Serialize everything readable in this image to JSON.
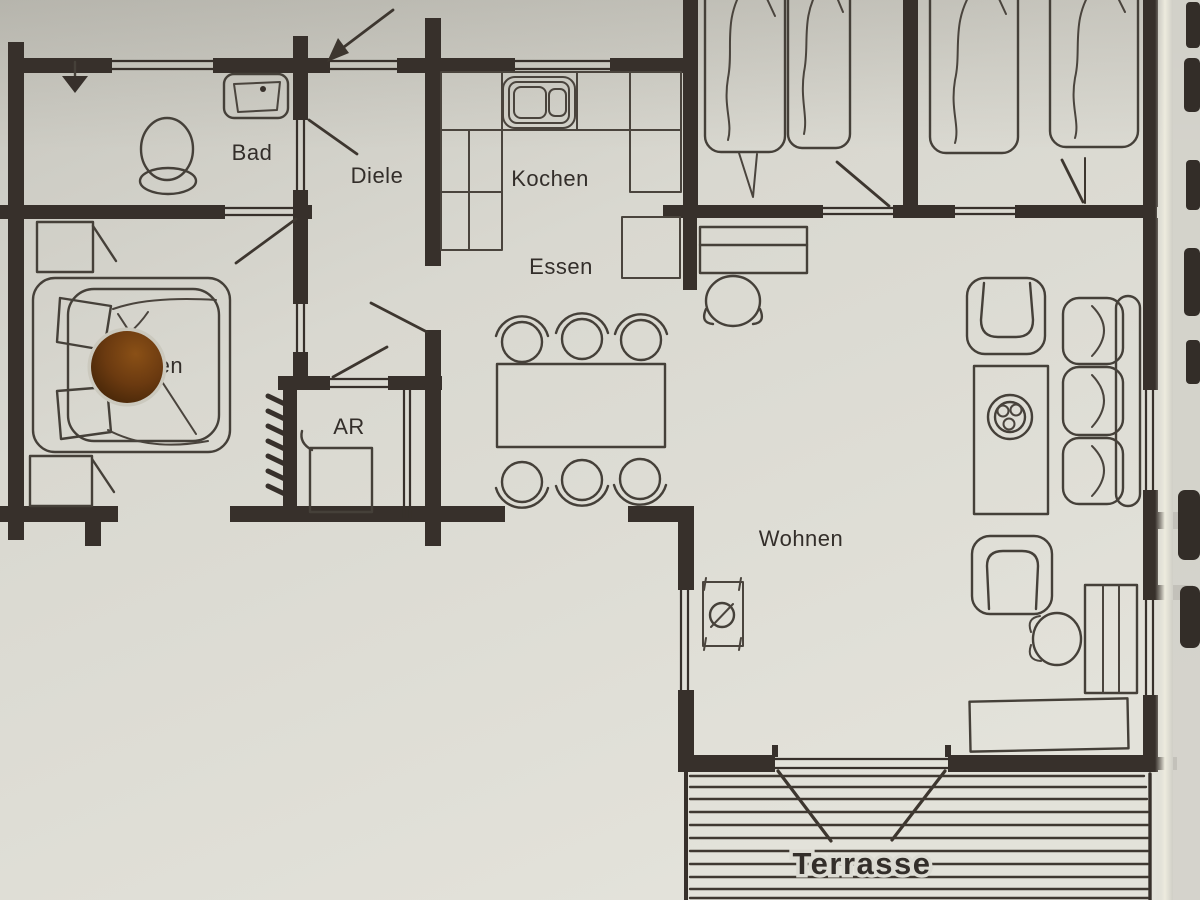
{
  "document": {
    "type": "floor-plan photograph",
    "language": "German"
  },
  "labels": {
    "bad": "Bad",
    "diele": "Diele",
    "kochen": "Kochen",
    "essen": "Essen",
    "schlafen_partial": "fen",
    "abstellraum": "AR",
    "wohnen": "Wohnen",
    "terrasse": "Terrasse"
  },
  "colors": {
    "paper": "#d9d8d0",
    "ink": "#37302b",
    "furniture_line": "#454039",
    "hole_punch": "#6b3a10"
  }
}
